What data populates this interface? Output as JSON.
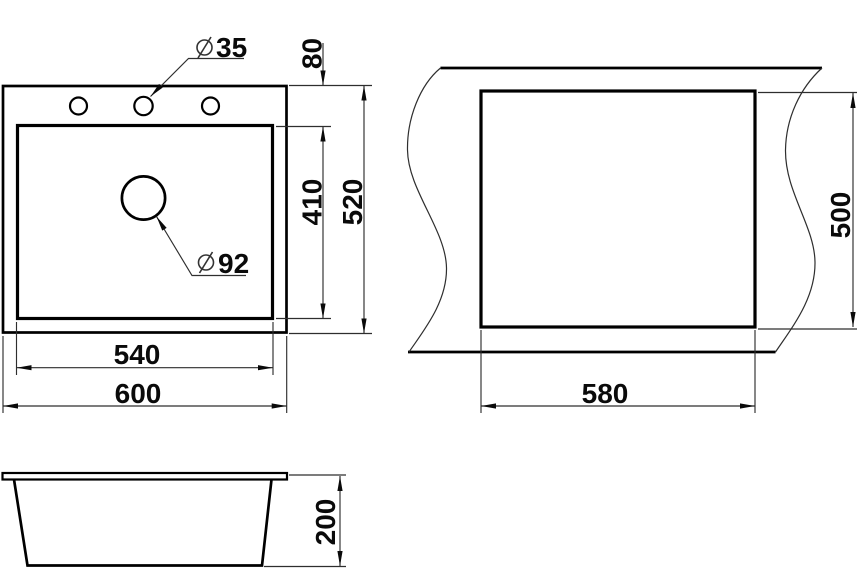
{
  "title": "Sink dimensional drawing",
  "views": {
    "top": {
      "faucet_hole_dia": "35",
      "drain_hole_dia": "92",
      "dims": {
        "rim_to_bowl_offset": "80",
        "bowl_depth": "410",
        "overall_depth": "520",
        "bowl_width": "540",
        "overall_width": "600"
      }
    },
    "cutout": {
      "dims": {
        "cutout_height": "500",
        "cutout_width": "580"
      }
    },
    "side": {
      "dims": {
        "sink_height": "200"
      }
    }
  },
  "colors": {
    "line": "#000000",
    "thin_line": "#2e2e2e",
    "text_color": "#0a0a0a",
    "background": "#ffffff"
  }
}
